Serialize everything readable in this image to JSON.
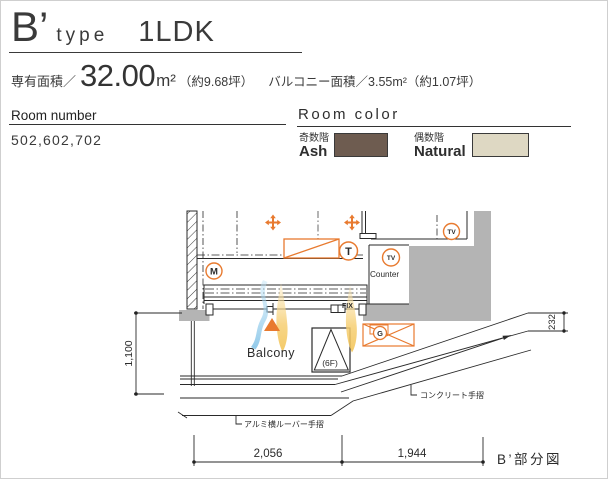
{
  "title": {
    "letter": "B’",
    "word": "type",
    "layout": "1LDK"
  },
  "areas": {
    "label": "専有面積／",
    "value": "32.00",
    "unit": "m²",
    "tsubo": "（約9.68坪）",
    "balcony": "バルコニー面積／3.55m²（約1.07坪）"
  },
  "room_number": {
    "label": "Room number",
    "value": "502,602,702"
  },
  "room_color": {
    "label": "Room color",
    "odd": {
      "floor": "奇数階",
      "name": "Ash",
      "hex": "#6e5c50"
    },
    "even": {
      "floor": "偶数階",
      "name": "Natural",
      "hex": "#ded8c3"
    }
  },
  "plan": {
    "balcony": "Balcony",
    "counter": "Counter",
    "fix": "FIX",
    "hatch_floor": "(6F)",
    "louver": "アルミ横ルーバー手摺",
    "concrete": "コンクリート手摺",
    "caption": "B’部分図",
    "dims": {
      "width_left": "2,056",
      "width_right": "1,944",
      "height": "1,100",
      "handrail": "232"
    },
    "icons": {
      "m": "M",
      "t": "T",
      "tv": "TV",
      "g": "G"
    },
    "accent_orange": "#e87a2f",
    "wall_gray": "#b4b4b4"
  }
}
